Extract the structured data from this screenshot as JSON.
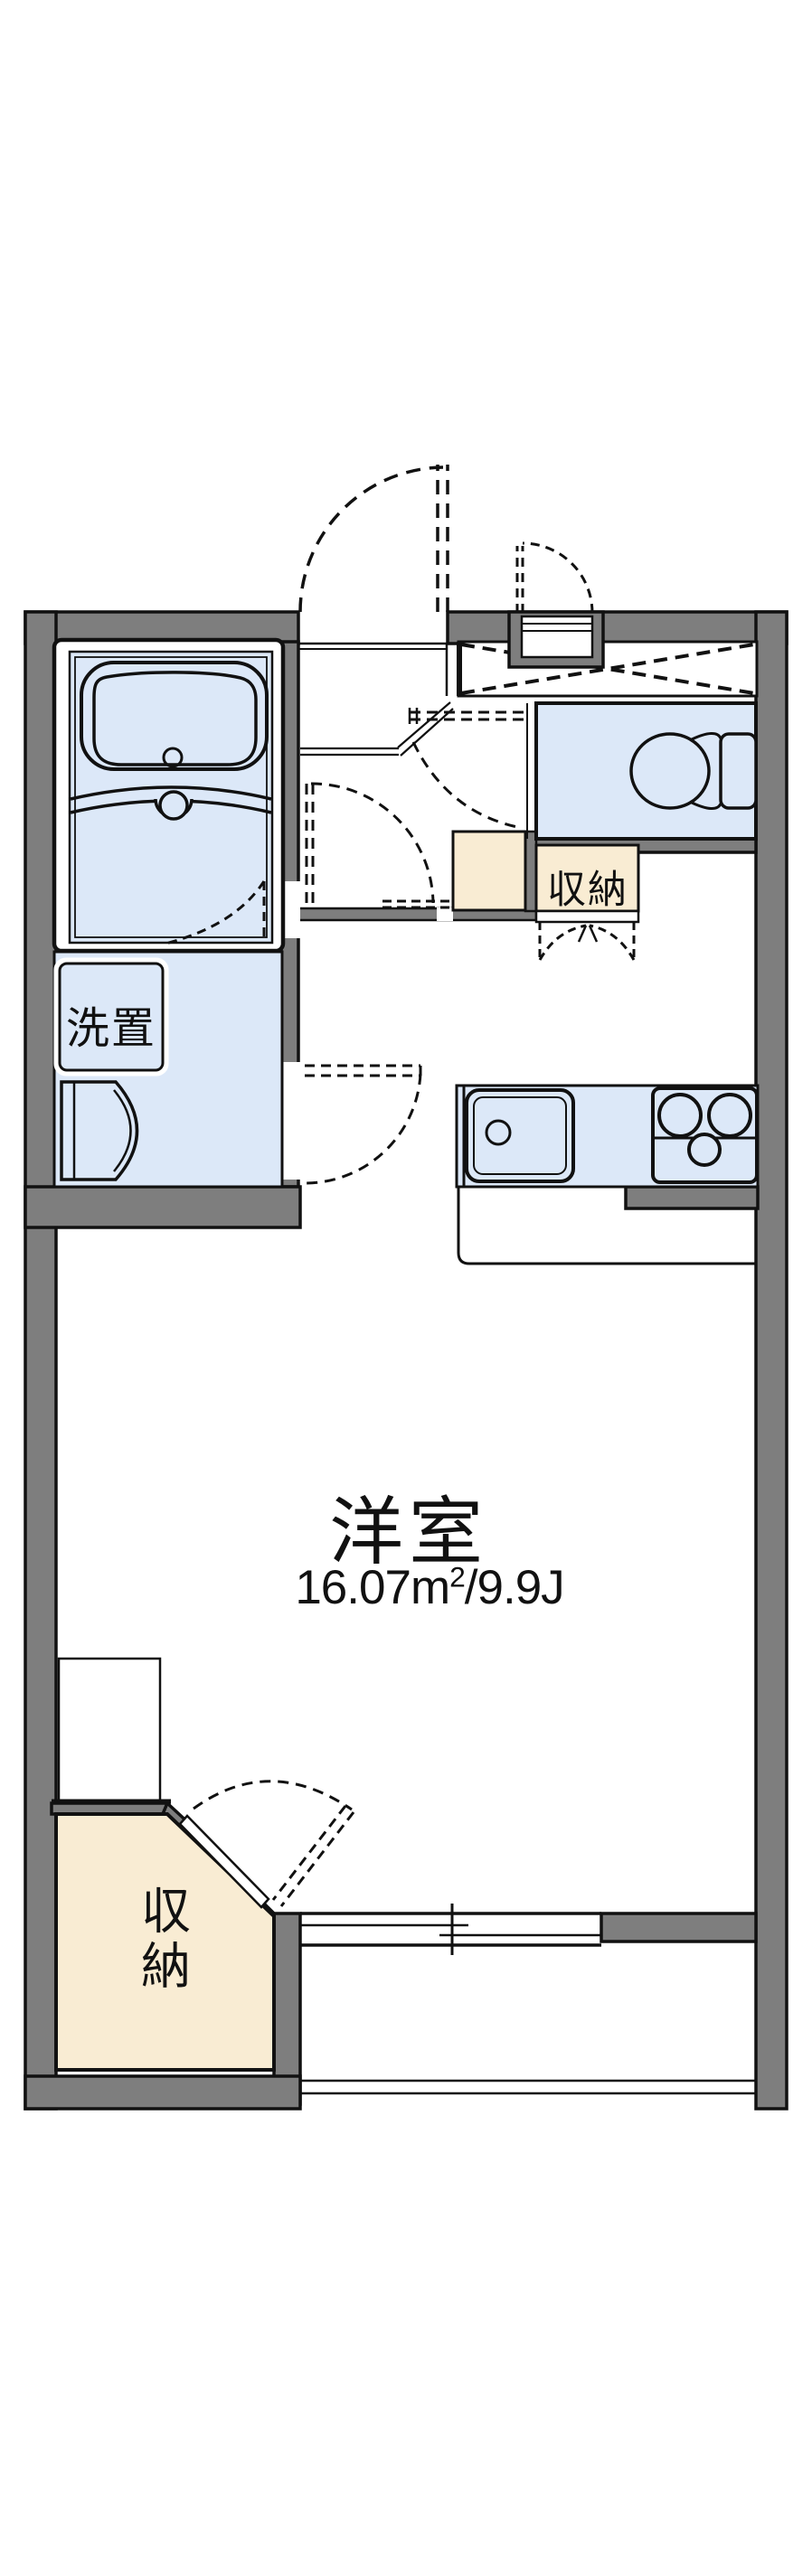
{
  "floor_plan": {
    "room_label": "洋室",
    "room_area": {
      "full": "16.07㎡/9.9J",
      "prefix": "16.07m",
      "superscript": "2",
      "suffix": "/9.9J"
    },
    "washer_label": "洗置",
    "storage_top_label": "収納",
    "storage_bottom_label": "収納",
    "colors": {
      "wall": "#7e7e7e",
      "wet_area": "#dce8f8",
      "storage": "#f9ecd3",
      "line": "#111111",
      "background": "#ffffff"
    }
  }
}
